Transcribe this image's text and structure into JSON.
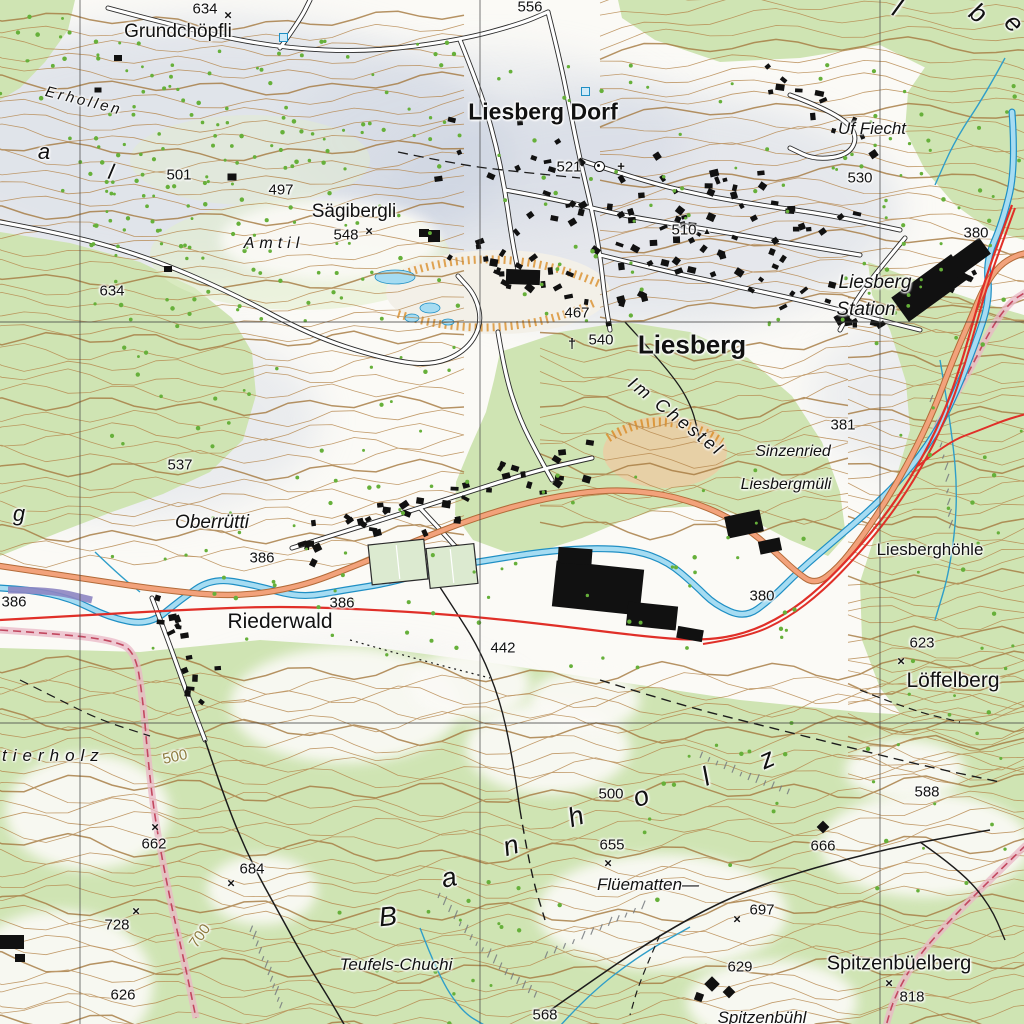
{
  "map": {
    "region": "Liesberg",
    "colors": {
      "forest": "#cfe4b3",
      "forest_light": "#e2eecb",
      "open": "#fbfaf6",
      "shade": "#c7cfdf",
      "contour": "#b5854a",
      "contour_index": "#a5793f",
      "water": "#a6dcf2",
      "water_edge": "#1f8fc4",
      "road_fill": "#f2a27b",
      "road_edge": "#b26a38",
      "minor_road": "#ffffff",
      "minor_edge": "#2b2b2b",
      "rail": "#e02f28",
      "tunnel_band": "#e9b7c6",
      "tunnel_line": "#c2485f",
      "culvert": "#8d85c2",
      "building": "#111111",
      "tree": "#66b03a",
      "rock": "#767b80",
      "field": "#dcead0",
      "quarry": "#e7d0a6",
      "hachure": "#d98e2b",
      "grid": "#444444",
      "label": "#111111",
      "contour_label": "#8d7b3e"
    },
    "grid": {
      "vertical": [
        80,
        480,
        880
      ],
      "horizontal": [
        322,
        723
      ]
    },
    "place_labels": [
      {
        "id": "grundchoepfli",
        "t": "Grundchöpfli",
        "x": 178,
        "y": 32,
        "s": 19
      },
      {
        "id": "liesberg-dorf",
        "t": "Liesberg Dorf",
        "x": 543,
        "y": 112,
        "s": 23,
        "b": 1
      },
      {
        "id": "saegibergli",
        "t": "Sägibergli",
        "x": 354,
        "y": 212,
        "s": 19
      },
      {
        "id": "amtil",
        "t": "Amtil",
        "x": 274,
        "y": 244,
        "s": 16,
        "i": 1,
        "ls": 5
      },
      {
        "id": "erhollen",
        "t": "Erhollen",
        "x": 84,
        "y": 101,
        "s": 15,
        "i": 1,
        "ls": 3,
        "r": 14
      },
      {
        "id": "uf-fiecht",
        "t": "Uf Fiecht",
        "x": 872,
        "y": 129,
        "s": 17,
        "i": 1
      },
      {
        "id": "liesberg",
        "t": "Liesberg",
        "x": 692,
        "y": 345,
        "s": 26,
        "b": 1
      },
      {
        "id": "liesberg-station-line1",
        "t": "Liesberg",
        "x": 875,
        "y": 283,
        "s": 19,
        "i": 1
      },
      {
        "id": "liesberg-station-line2",
        "t": "Station",
        "x": 866,
        "y": 310,
        "s": 19,
        "i": 1
      },
      {
        "id": "im-chestel",
        "t": "Im Chestel",
        "x": 676,
        "y": 417,
        "s": 18,
        "i": 1,
        "ls": 3,
        "r": 38
      },
      {
        "id": "sinzenried",
        "t": "Sinzenried",
        "x": 793,
        "y": 452,
        "s": 16,
        "i": 1
      },
      {
        "id": "liesbergmueli",
        "t": "Liesbergmüli",
        "x": 786,
        "y": 485,
        "s": 16,
        "i": 1
      },
      {
        "id": "liesberghoehle",
        "t": "Liesberghöhle",
        "x": 930,
        "y": 550,
        "s": 17
      },
      {
        "id": "oberruetti",
        "t": "Oberrütti",
        "x": 212,
        "y": 523,
        "s": 19,
        "i": 1
      },
      {
        "id": "riederwald",
        "t": "Riederwald",
        "x": 280,
        "y": 622,
        "s": 21
      },
      {
        "id": "loeffelberg",
        "t": "Löffelberg",
        "x": 953,
        "y": 681,
        "s": 21
      },
      {
        "id": "flueematten",
        "t": "Flüematten—",
        "x": 648,
        "y": 885,
        "s": 17,
        "i": 1
      },
      {
        "id": "teufels-chuchi",
        "t": "Teufels-Chuchi",
        "x": 396,
        "y": 965,
        "s": 17,
        "i": 1
      },
      {
        "id": "spitzenbueelberg",
        "t": "Spitzenbüelberg",
        "x": 899,
        "y": 964,
        "s": 20
      },
      {
        "id": "spitzenbuehl",
        "t": "Spitzenbühl",
        "x": 762,
        "y": 1018,
        "s": 17,
        "i": 1
      },
      {
        "id": "banholz-b",
        "t": "B",
        "x": 388,
        "y": 917,
        "s": 27,
        "i": 1,
        "r": -6
      },
      {
        "id": "banholz-a",
        "t": "a",
        "x": 449,
        "y": 878,
        "s": 27,
        "i": 1,
        "r": -12
      },
      {
        "id": "banholz-n",
        "t": "n",
        "x": 511,
        "y": 846,
        "s": 27,
        "i": 1,
        "r": -16
      },
      {
        "id": "banholz-h",
        "t": "h",
        "x": 576,
        "y": 817,
        "s": 27,
        "i": 1,
        "r": -18
      },
      {
        "id": "banholz-o",
        "t": "o",
        "x": 641,
        "y": 797,
        "s": 27,
        "i": 1,
        "r": -20
      },
      {
        "id": "banholz-l",
        "t": "l",
        "x": 706,
        "y": 777,
        "s": 27,
        "i": 1,
        "r": -22
      },
      {
        "id": "banholz-z",
        "t": "z",
        "x": 767,
        "y": 759,
        "s": 27,
        "i": 1,
        "r": -24
      },
      {
        "id": "tierholz",
        "t": "tierholz",
        "x": 2,
        "y": 756,
        "s": 17,
        "i": 1,
        "ls": 6,
        "a": "left"
      },
      {
        "id": "valley-letter-a",
        "t": "a",
        "x": 44,
        "y": 152,
        "s": 22,
        "i": 1
      },
      {
        "id": "valley-letter-l",
        "t": "l",
        "x": 111,
        "y": 172,
        "s": 22,
        "i": 1,
        "r": 12
      },
      {
        "id": "hill-letter-g",
        "t": "g",
        "x": 19,
        "y": 514,
        "s": 22,
        "i": 1
      },
      {
        "id": "corner-letter-l",
        "t": "l",
        "x": 897,
        "y": 8,
        "s": 26,
        "i": 1,
        "r": 25
      },
      {
        "id": "corner-letter-b",
        "t": "b",
        "x": 978,
        "y": 13,
        "s": 26,
        "i": 1,
        "r": 35
      },
      {
        "id": "corner-letter-e",
        "t": "e",
        "x": 1014,
        "y": 23,
        "s": 26,
        "i": 1,
        "r": 45
      }
    ],
    "spot_heights": [
      {
        "id": "spot-634-top",
        "t": "634",
        "x": 205,
        "y": 9
      },
      {
        "id": "spot-556",
        "t": "556",
        "x": 530,
        "y": 7
      },
      {
        "id": "spot-501",
        "t": "501",
        "x": 179,
        "y": 175
      },
      {
        "id": "spot-497",
        "t": "497",
        "x": 281,
        "y": 190
      },
      {
        "id": "spot-548",
        "t": "548",
        "x": 346,
        "y": 235
      },
      {
        "id": "spot-634-left",
        "t": "634",
        "x": 112,
        "y": 291
      },
      {
        "id": "spot-521",
        "t": "521",
        "x": 569,
        "y": 167
      },
      {
        "id": "spot-530",
        "t": "530",
        "x": 860,
        "y": 178
      },
      {
        "id": "spot-510",
        "t": "510",
        "x": 684,
        "y": 230
      },
      {
        "id": "spot-467",
        "t": "467",
        "x": 577,
        "y": 313
      },
      {
        "id": "spot-540",
        "t": "540",
        "x": 601,
        "y": 340
      },
      {
        "id": "spot-380-station",
        "t": "380",
        "x": 976,
        "y": 233
      },
      {
        "id": "spot-381",
        "t": "381",
        "x": 843,
        "y": 425
      },
      {
        "id": "spot-537",
        "t": "537",
        "x": 180,
        "y": 465
      },
      {
        "id": "spot-386-oberruetti",
        "t": "386",
        "x": 262,
        "y": 558
      },
      {
        "id": "spot-386-left",
        "t": "386",
        "x": 14,
        "y": 602
      },
      {
        "id": "spot-386-riederwald",
        "t": "386",
        "x": 342,
        "y": 603
      },
      {
        "id": "spot-442",
        "t": "442",
        "x": 503,
        "y": 648
      },
      {
        "id": "spot-380-river",
        "t": "380",
        "x": 762,
        "y": 596
      },
      {
        "id": "spot-623",
        "t": "623",
        "x": 922,
        "y": 643
      },
      {
        "id": "spot-588",
        "t": "588",
        "x": 927,
        "y": 792
      },
      {
        "id": "spot-666",
        "t": "666",
        "x": 823,
        "y": 846
      },
      {
        "id": "spot-662",
        "t": "662",
        "x": 154,
        "y": 844
      },
      {
        "id": "spot-684",
        "t": "684",
        "x": 252,
        "y": 869
      },
      {
        "id": "spot-728",
        "t": "728",
        "x": 117,
        "y": 925
      },
      {
        "id": "spot-626",
        "t": "626",
        "x": 123,
        "y": 995
      },
      {
        "id": "spot-500-banholz",
        "t": "500",
        "x": 611,
        "y": 794
      },
      {
        "id": "spot-655",
        "t": "655",
        "x": 612,
        "y": 845
      },
      {
        "id": "spot-697",
        "t": "697",
        "x": 762,
        "y": 910
      },
      {
        "id": "spot-629",
        "t": "629",
        "x": 740,
        "y": 967
      },
      {
        "id": "spot-818",
        "t": "818",
        "x": 912,
        "y": 997
      },
      {
        "id": "spot-568",
        "t": "568",
        "x": 545,
        "y": 1015
      }
    ],
    "contour_labels": [
      {
        "id": "contour-500",
        "t": "500",
        "x": 175,
        "y": 757,
        "s": 15,
        "r": -12
      },
      {
        "id": "contour-700",
        "t": "700",
        "x": 200,
        "y": 936,
        "s": 15,
        "r": -55
      }
    ],
    "markers": [
      {
        "type": "x",
        "x": 228,
        "y": 15
      },
      {
        "type": "x",
        "x": 369,
        "y": 231
      },
      {
        "type": "x",
        "x": 901,
        "y": 661
      },
      {
        "type": "x",
        "x": 155,
        "y": 827
      },
      {
        "type": "x",
        "x": 231,
        "y": 883
      },
      {
        "type": "x",
        "x": 136,
        "y": 911
      },
      {
        "type": "x",
        "x": 608,
        "y": 863
      },
      {
        "type": "x",
        "x": 737,
        "y": 919
      },
      {
        "type": "x",
        "x": 889,
        "y": 983
      },
      {
        "type": "triangle",
        "x": 707,
        "y": 231
      },
      {
        "type": "dagger",
        "x": 572,
        "y": 343
      },
      {
        "type": "church",
        "x": 599,
        "y": 166
      },
      {
        "type": "plus",
        "x": 621,
        "y": 166
      },
      {
        "type": "bluesquare",
        "x": 283,
        "y": 37
      },
      {
        "type": "bluesquare",
        "x": 585,
        "y": 91
      }
    ]
  }
}
